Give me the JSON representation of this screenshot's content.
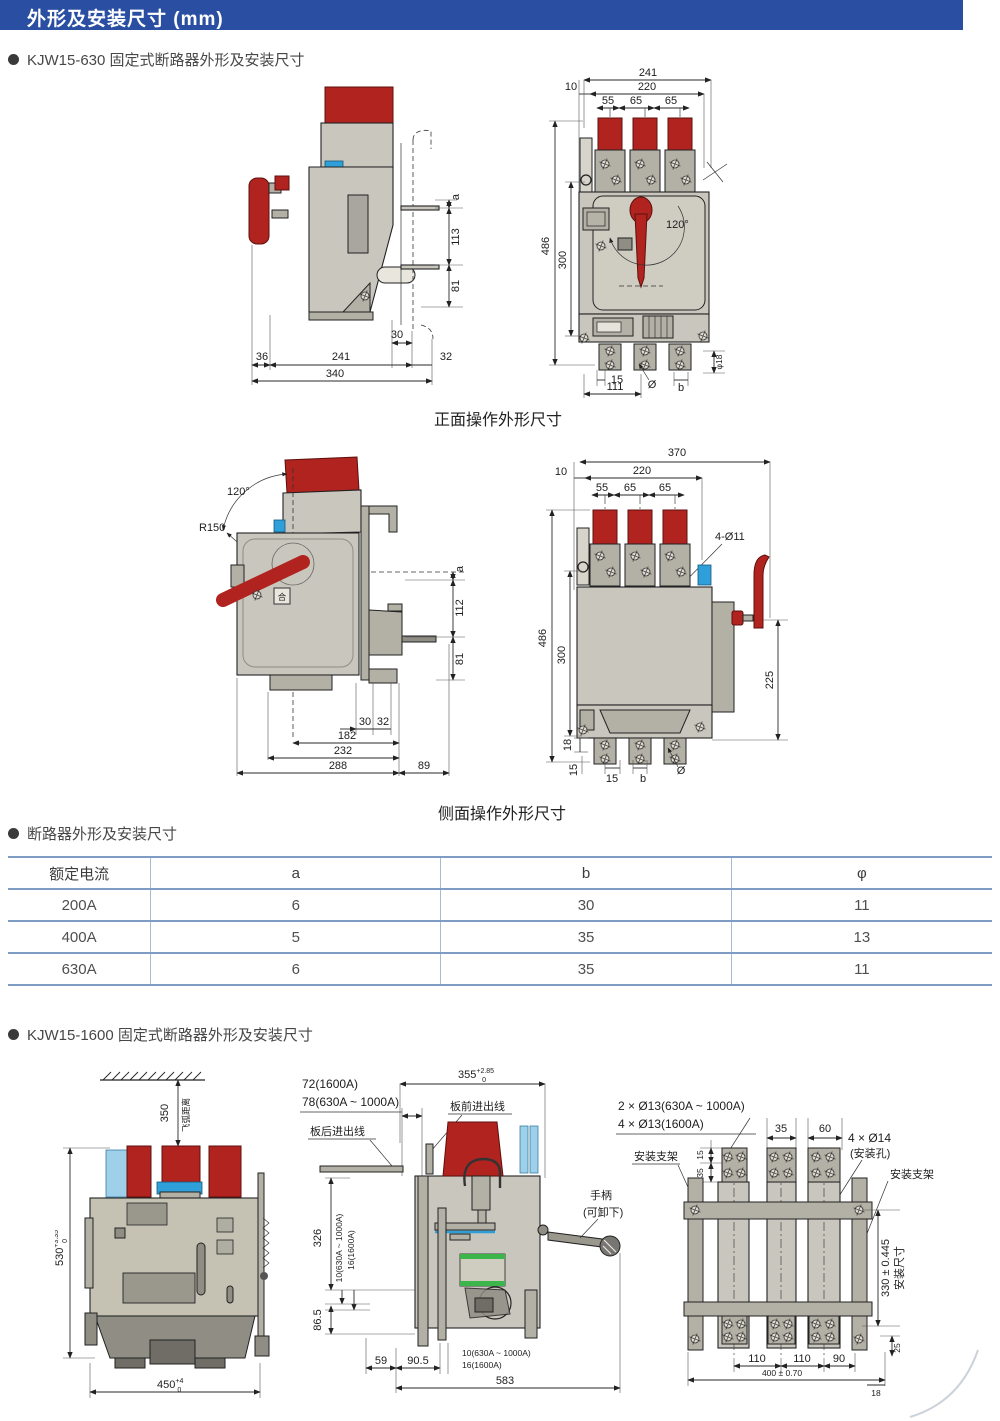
{
  "header": {
    "title": "外形及安装尺寸 (mm)"
  },
  "sections": {
    "kjw630_bullet": "KJW15-630 固定式断路器外形及安装尺寸",
    "front_caption": "正面操作外形尺寸",
    "side_caption": "侧面操作外形尺寸",
    "table_bullet": "断路器外形及安装尺寸",
    "kjw1600_bullet": "KJW15-1600 固定式断路器外形及安装尺寸"
  },
  "table": {
    "headers": [
      "额定电流",
      "a",
      "b",
      "φ"
    ],
    "rows": [
      [
        "200A",
        "6",
        "30",
        "11"
      ],
      [
        "400A",
        "5",
        "35",
        "13"
      ],
      [
        "630A",
        "6",
        "35",
        "11"
      ]
    ]
  },
  "d1s": {
    "a": "a",
    "h113": "113",
    "h81": "81",
    "w36": "36",
    "w241": "241",
    "w30": "30",
    "w32": "32",
    "w340": "340"
  },
  "d1f": {
    "w241": "241",
    "w220": "220",
    "w10": "10",
    "w55": "55",
    "w65a": "65",
    "w65b": "65",
    "h486": "486",
    "h300": "300",
    "ang": "120°",
    "w15": "15",
    "dia": "Ø",
    "b": "b",
    "w111": "111",
    "d18": "φ18"
  },
  "d2s": {
    "ang": "120°",
    "r": "R150",
    "sym": "合",
    "a": "a",
    "h112": "112",
    "h81": "81",
    "w30": "30",
    "w32": "32",
    "w182": "182",
    "w232": "232",
    "w288": "288",
    "w89": "89"
  },
  "d2f": {
    "w370": "370",
    "w10": "10",
    "w220": "220",
    "w55": "55",
    "w65a": "65",
    "w65b": "65",
    "holes": "4-Ø11",
    "h486": "486",
    "h300": "300",
    "h225": "225",
    "h18": "18",
    "v15": "15",
    "w15": "15",
    "b": "b",
    "dia": "Ø"
  },
  "d3l": {
    "h350": "350",
    "arc": "飞弧距离",
    "v530": "530",
    "t530sup": "+3.35",
    "t530sub": "0",
    "w450": "450",
    "t450sup": "+4",
    "t450sub": "0"
  },
  "d3m": {
    "l72": "72(1600A)",
    "l78": "78(630A ~ 1000A)",
    "rear": "板后进出线",
    "front": "板前进出线",
    "w355": "355",
    "t355sup": "+2.85",
    "t355sub": "0",
    "handle1": "手柄",
    "handle2": "(可卸下)",
    "h326": "326",
    "r10": "10(630A ~ 1000A)",
    "r16": "16(1600A)",
    "h865": "86.5",
    "w59": "59",
    "w905": "90.5",
    "b10": "10(630A ~ 1000A)",
    "b16": "16(1600A)",
    "w583": "583"
  },
  "d3r": {
    "l2": "2 × Ø13(630A ~ 1000A)",
    "l4": "4 × Ø13(1600A)",
    "bracket_l": "安装支架",
    "w35": "35",
    "w60": "60",
    "l14": "4 × Ø14",
    "hole": "(安装孔)",
    "bracket_r": "安装支架",
    "v15": "15",
    "v35": "35",
    "h330": "330 ± 0.445",
    "mount": "安装尺寸",
    "w110a": "110",
    "w110b": "110",
    "w90": "90",
    "w400": "400 ± 0.70",
    "v25": "25",
    "h18": "18"
  }
}
